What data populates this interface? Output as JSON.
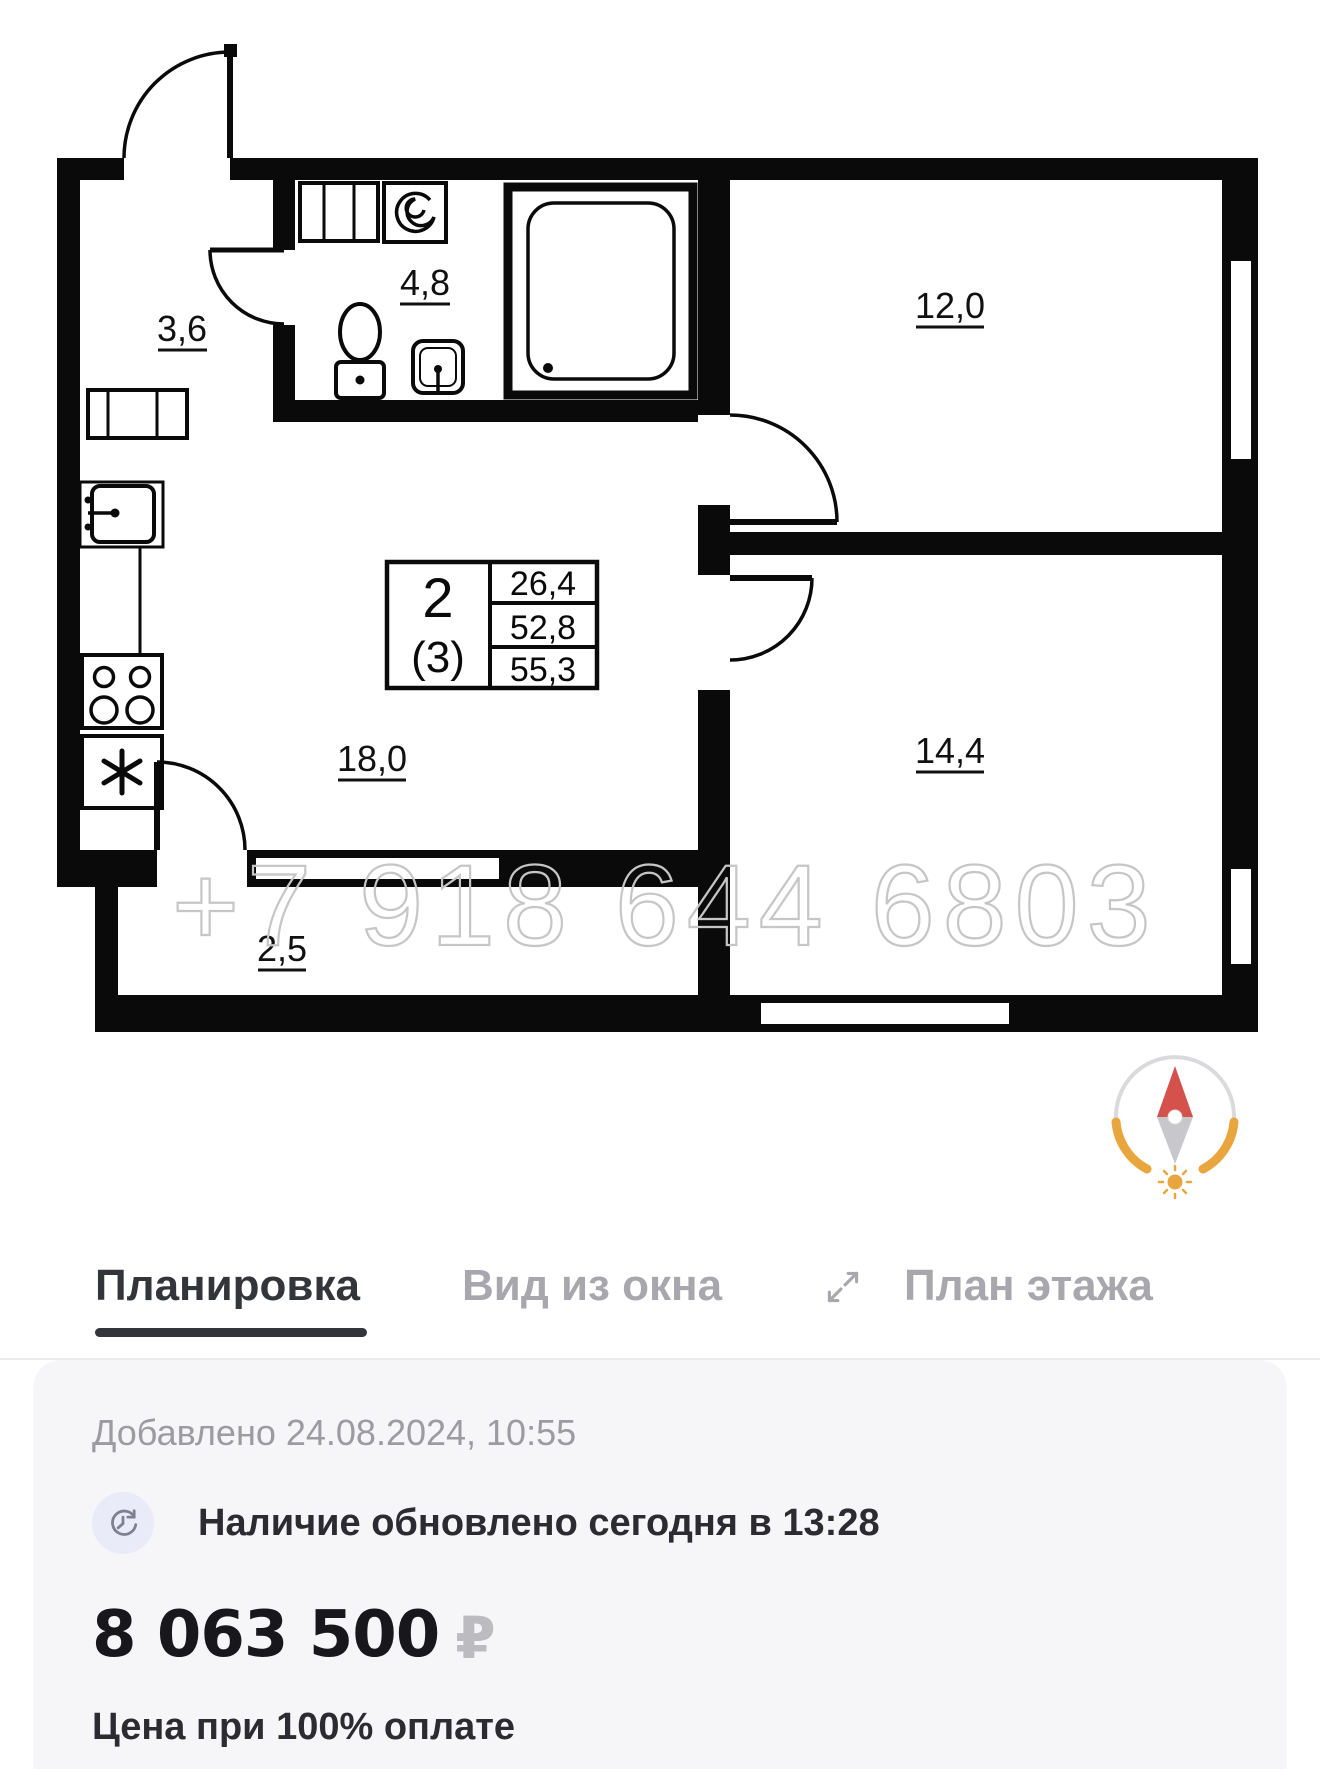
{
  "plan": {
    "watermark": "+7 918 644 6803",
    "rooms": {
      "hallway": "3,6",
      "bathroom": "4,8",
      "bedroom1": "12,0",
      "kitchen_living": "18,0",
      "bedroom2": "14,4",
      "balcony": "2,5"
    },
    "info_box": {
      "rooms_count": "2",
      "rooms_alt": "(3)",
      "area_living": "26,4",
      "area_main": "52,8",
      "area_total": "55,3"
    }
  },
  "tabs": {
    "layout": "Планировка",
    "window_view": "Вид из окна",
    "floor_plan": "План этажа"
  },
  "card": {
    "added": "Добавлено 24.08.2024, 10:55",
    "availability": "Наличие обновлено сегодня в 13:28",
    "price": "8 063 500",
    "currency_symbol": "₽",
    "price_note": "Цена при 100% оплате"
  },
  "colors": {
    "wall_black": "#0a0a0a",
    "watermark_gray": "#c6c6c6",
    "tab_active": "#33353a",
    "tab_inactive": "#a7a7ad",
    "card_bg": "#f6f6f8",
    "compass_red": "#d5524c",
    "compass_orange": "#eaa63e"
  }
}
